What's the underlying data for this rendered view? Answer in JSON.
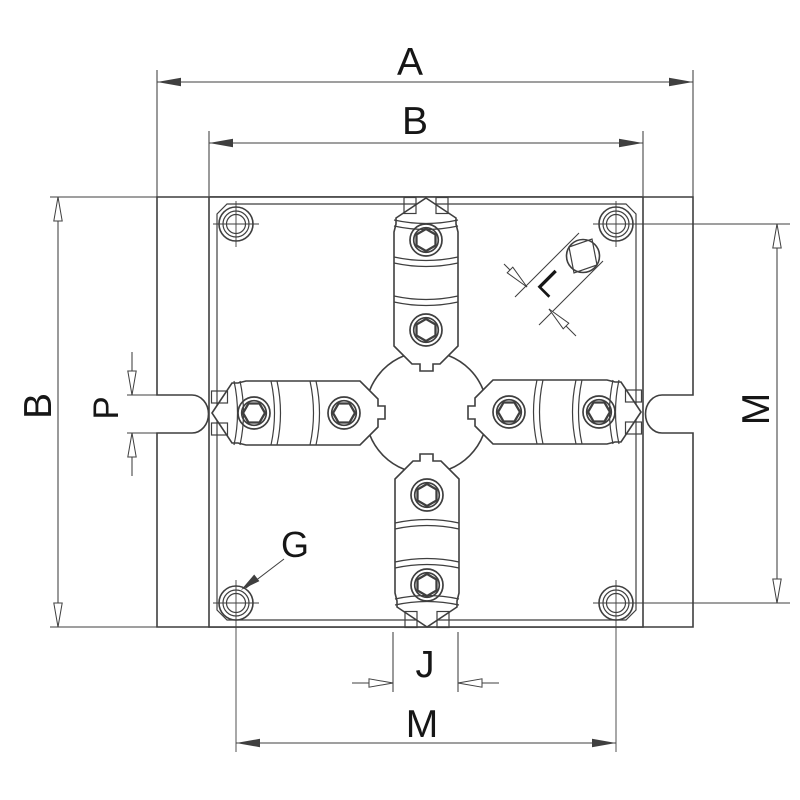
{
  "drawing": {
    "kind": "technical-drawing",
    "labels": {
      "overall_width": "A",
      "body_width_top": "B",
      "body_height_left": "B",
      "side_slot_width": "P",
      "hole_pitch_right": "M",
      "hole_pitch_bottom": "M",
      "jaw_width": "J",
      "pin_size": "L",
      "mount_hole_ref": "G"
    },
    "colors": {
      "background": "#ffffff",
      "line": "#3f3f3f",
      "text": "#161616"
    }
  }
}
